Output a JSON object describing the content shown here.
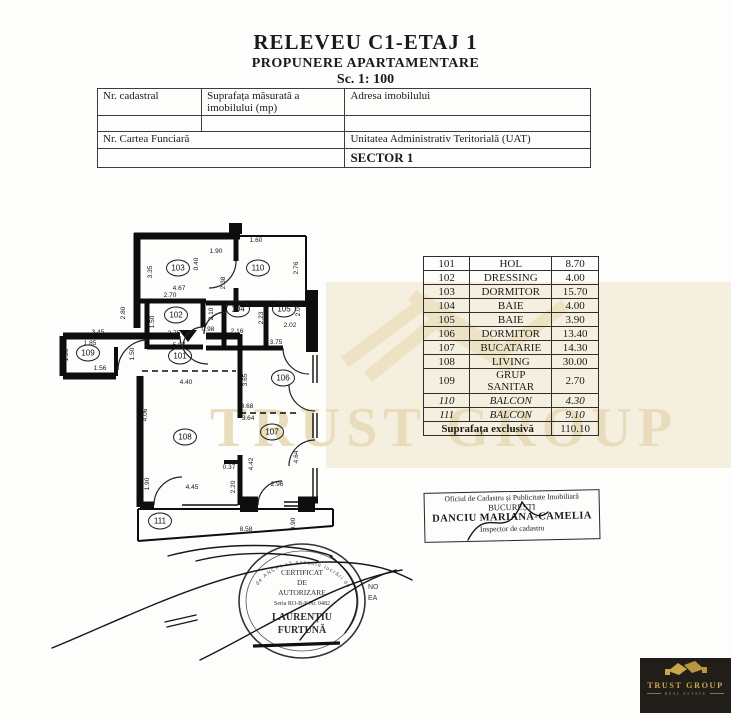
{
  "header": {
    "title": "RELEVEU C1-ETAJ 1",
    "subtitle": "PROPUNERE APARTAMENTARE",
    "scale": "Sc. 1: 100"
  },
  "info": {
    "h1": "Nr. cadastral",
    "h2": "Suprafața măsurată a imobilului (mp)",
    "h3": "Adresa imobilului",
    "cf": "Nr. Cartea Funciară",
    "uat": "Unitatea Administrativ Teritorială (UAT)",
    "sector": "SECTOR 1"
  },
  "rooms": [
    {
      "id": "101",
      "name": "HOL",
      "area": "8.70"
    },
    {
      "id": "102",
      "name": "DRESSING",
      "area": "4.00"
    },
    {
      "id": "103",
      "name": "DORMITOR",
      "area": "15.70"
    },
    {
      "id": "104",
      "name": "BAIE",
      "area": "4.00"
    },
    {
      "id": "105",
      "name": "BAIE",
      "area": "3.90"
    },
    {
      "id": "106",
      "name": "DORMITOR",
      "area": "13.40"
    },
    {
      "id": "107",
      "name": "BUCATARIE",
      "area": "14.30"
    },
    {
      "id": "108",
      "name": "LIVING",
      "area": "30.00"
    },
    {
      "id": "109",
      "name": "GRUP SANITAR",
      "area": "2.70"
    },
    {
      "id": "110",
      "name": "BALCON",
      "area": "4.30"
    },
    {
      "id": "111",
      "name": "BALCON",
      "area": "9.10"
    }
  ],
  "total": {
    "label": "Suprafața exclusivă",
    "value": "110.10"
  },
  "plan": {
    "room_labels": [
      "103",
      "110",
      "102",
      "104",
      "105",
      "109",
      "101",
      "106",
      "108",
      "107",
      "111"
    ],
    "dims": [
      "1.60",
      "1.90",
      "0.40",
      "2.76",
      "3.35",
      "4.67",
      "2.38",
      "2.70",
      "2.80",
      "1.50",
      "2.75",
      "2.10",
      "2.16",
      "2.23",
      "2.05",
      "2.02",
      "0.98",
      "3.45",
      "1.85",
      "1.50",
      "1.50",
      "1.56",
      "5.97",
      "4.40",
      "3.75",
      "3.65",
      "3.68",
      "3.64",
      "4.06",
      "4.42",
      "4.64",
      "0.37",
      "2.20",
      "2.96",
      "1.90",
      "4.45",
      "8.58",
      "0.90"
    ]
  },
  "office_stamp": {
    "line1": "Oficiul de Cadastru și Publicitate Imobiliară",
    "line2": "BUCUREȘTI",
    "line3": "DANCIU MARIANA-CAMELIA",
    "line4": "Inspector de cadastru"
  },
  "cert_stamp": {
    "ring": "de ANCPI să execute lucrări de",
    "l1": "CERTIFICAT",
    "l2": "DE",
    "l3": "AUTORIZARE",
    "l4": "Seria RO-B-F Nr. 0482",
    "l5": "LAURENȚIU",
    "l6": "FURTUNĂ",
    "frag1": "NO",
    "frag2": "EA"
  },
  "watermark": {
    "text": "TRUST GROUP"
  },
  "logo": {
    "name": "TRUST GROUP",
    "sub": "REAL ESTATE"
  }
}
